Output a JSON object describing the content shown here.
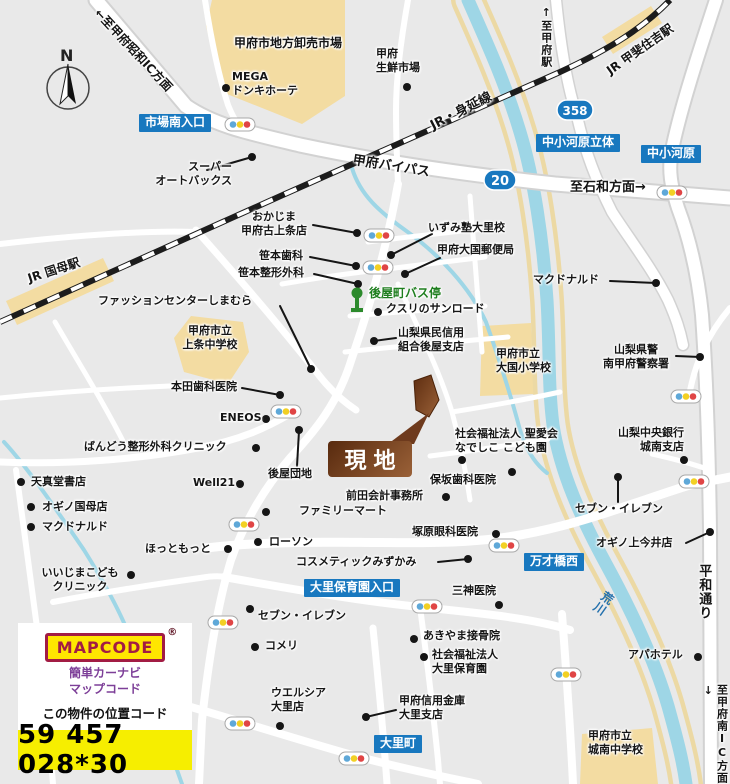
{
  "colors": {
    "background": "#e9e9e9",
    "road": "#ffffff",
    "building": "#f3dca2",
    "river": "#9ed6e6",
    "river_bank": "#ecd9a4",
    "sign_blue": "#1878bf",
    "bus_green": "#1e7e1e",
    "site_brown": "#6e3a1d",
    "mapcode_maroon": "#a21c44",
    "mapcode_yellow": "#ffe600",
    "mapcode_purple": "#7d3f98",
    "code_bar_yellow": "#f6ee00"
  },
  "compass": {
    "n": "N"
  },
  "badges": {
    "r20": "20",
    "r358": "358"
  },
  "signs": {
    "shijo_minami": "市場南入口",
    "nakakogawara_rittai": "中小河原立体",
    "nakakogawara": "中小河原",
    "mansaibashi_nishi": "万才橋西",
    "osato_hoikuen_iriguchi": "大里保育園入口",
    "osato_cho": "大里町"
  },
  "site": {
    "label": "現地"
  },
  "bus_stop": {
    "label": "後屋町バス停"
  },
  "roads": {
    "bypass": "甲府バイパス",
    "to_showa_ic": "←至甲府昭和IC方面",
    "to_isawa": "至石和方面→",
    "to_kofu_station": "↑至甲府駅",
    "heiwa_dori": "平和通り",
    "to_kofu_minami_ic": "至甲府南IC方面↓",
    "arakawa_river": "荒川"
  },
  "rail": {
    "minobu_line": "JR・身延線",
    "kokubo_station": "JR 国母駅",
    "kaisumiyoshi_station": "JR 甲斐住吉駅"
  },
  "places": {
    "wholesale_market": "甲府市地方卸売市場",
    "mega_donki": "MEGA\nドンキホーテ",
    "seisen_market": "甲府\n生鮮市場",
    "autobacs": "スーパー\nオートバックス",
    "okajima": "おかじま\n甲府古上条店",
    "sasamoto_dental": "笹本歯科",
    "sasamoto_seikei": "笹本整形外科",
    "izumi_juku": "いずみ塾大里校",
    "daikoku_post": "甲府大国郵便局",
    "kusuri_sunroad": "クスリのサンロード",
    "shimamura": "ファッションセンターしまむら",
    "kamijo_jhs": "甲府市立\n上条中学校",
    "shinyo_kumiai": "山梨県民信用\n組合後屋支店",
    "daikoku_es": "甲府市立\n大国小学校",
    "mcdonalds_ne": "マクドナルド",
    "police": "山梨県警\n南甲府警察署",
    "honda_dental": "本田歯科医院",
    "eneos": "ENEOS",
    "bando_clinic": "ばんどう整形外科クリニック",
    "goya_danchi": "後屋団地",
    "well21": "Well21",
    "nadeshiko": "社会福祉法人 聖愛会\nなでしこ こども園",
    "hosaka_dental": "保坂歯科医院",
    "maeda_kaikei": "前田会計事務所",
    "familymart": "ファミリーマート",
    "lawson": "ローソン",
    "hottomotto": "ほっともっと",
    "tsukahara_eye": "塚原眼科医院",
    "cosmetic_mizukami": "コスメティックみずかみ",
    "tenshindo": "天真堂書店",
    "ogino_kokubo": "オギノ国母店",
    "mcdonalds_sw": "マクドナルド",
    "iijima_kids": "いいじまこども\nクリニック",
    "chuo_bank": "山梨中央銀行\n城南支店",
    "seven_eleven_e": "セブン・イレブン",
    "ogino_kamiimai": "オギノ上今井店",
    "mikami_clinic": "三神医院",
    "seven_eleven_w": "セブン・イレブン",
    "akiyama": "あきやま接骨院",
    "osato_hoikuen": "社会福祉法人\n大里保育園",
    "komeri": "コメリ",
    "welcia": "ウエルシア\n大里店",
    "kofu_shinkin": "甲府信用金庫\n大里支店",
    "jonan_jhs": "甲府市立\n城南中学校",
    "apa_hotel": "アパホテル"
  },
  "mapcode": {
    "logo": "MAPCODE",
    "reg": "®",
    "tagline": "簡単カーナビ\nマップコード",
    "caption": "この物件の位置コード",
    "code": "59 457 028*30"
  }
}
